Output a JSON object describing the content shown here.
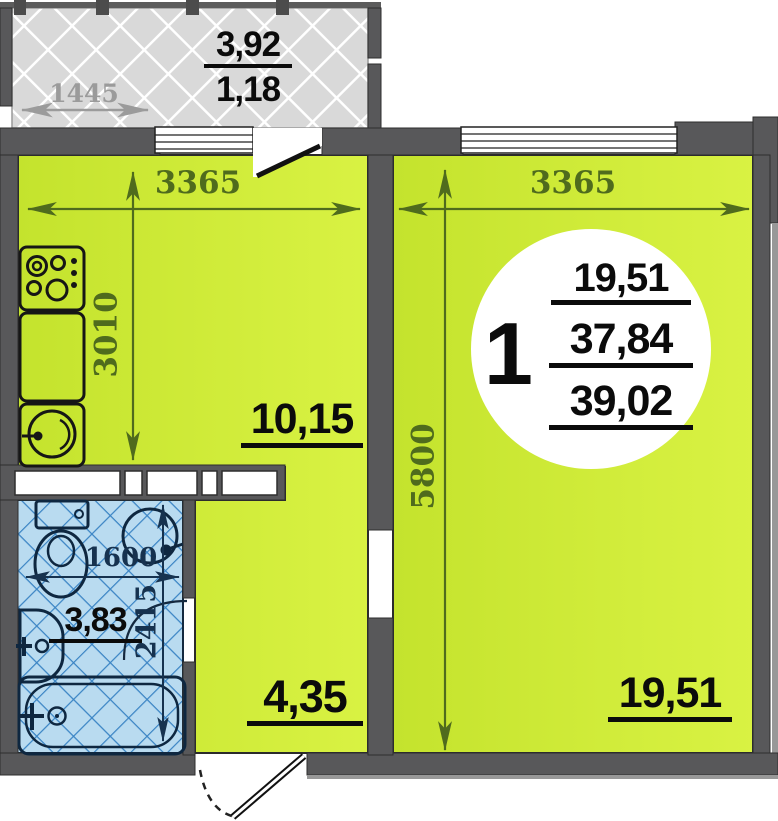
{
  "floorplan": {
    "badge": {
      "rooms_count": "1",
      "living_area": "19,51",
      "apartment_area": "37,84",
      "total_area": "39,02"
    },
    "rooms": {
      "living_room": {
        "area": "19,51",
        "width": "3365",
        "depth": "5800"
      },
      "kitchen": {
        "area": "10,15",
        "width": "3365",
        "depth": "3010"
      },
      "hallway": {
        "area": "4,35"
      },
      "bathroom": {
        "area": "3,83",
        "width": "1600",
        "depth": "2415"
      },
      "balcony": {
        "area_full": "3,92",
        "area_reduced": "1,18",
        "width": "1445"
      }
    },
    "colors": {
      "room_fill": "#cfe93a",
      "wall": "#58585a",
      "bathroom_fill": "#b9dbf0",
      "bathroom_hatch_line": "#3a84c4",
      "balcony_fill": "#d9d9d9",
      "dimension_green": "#4f6b1d",
      "dimension_gray": "#9b9b9b",
      "dimension_blue": "#16324f"
    }
  }
}
